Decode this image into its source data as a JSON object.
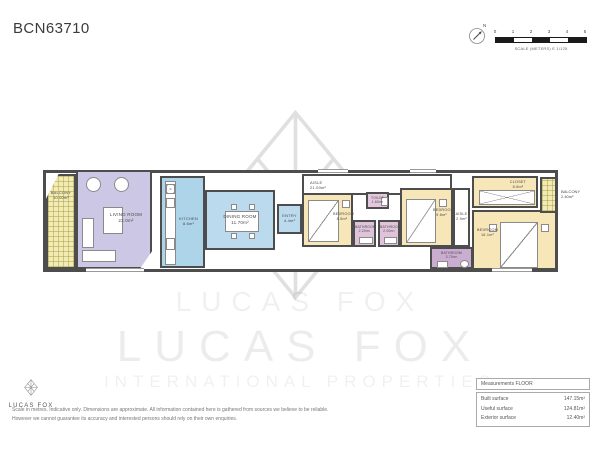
{
  "title": "BCN63710",
  "compass": {
    "north": "N"
  },
  "scale_bar": {
    "ticks": [
      "0",
      "1",
      "2",
      "3",
      "4",
      "5"
    ],
    "caption": "SCALE (METERS) E 1/125"
  },
  "watermark": {
    "small": "LUCAS FOX",
    "large": "LUCAS FOX",
    "sub": "INTERNATIONAL PROPERTIES"
  },
  "plan": {
    "rooms": {
      "balcony_left": {
        "name": "BALCONY",
        "area": "10.00m²"
      },
      "living_room": {
        "name": "LIVING ROOM",
        "area": "22.0m²"
      },
      "kitchen": {
        "name": "KITCHEN",
        "area": "8.6m²"
      },
      "dining_room": {
        "name": "DINING ROOM",
        "area": "11.70m²"
      },
      "entry": {
        "name": "ENTRY",
        "area": "4.4m²"
      },
      "aisle_main": {
        "name": "AISLE",
        "area": "21.00m²"
      },
      "bedroom_1": {
        "name": "BEDROOM",
        "area": "8.5m²"
      },
      "toilet": {
        "name": "TOILET",
        "area": "1.60m²"
      },
      "bathroom_1": {
        "name": "BATHROOM",
        "area": "2.20m²"
      },
      "bathroom_2": {
        "name": "BATHROOM",
        "area": "2.00m²"
      },
      "bedroom_2": {
        "name": "BEDROOM",
        "area": "9.6m²"
      },
      "aisle_2": {
        "name": "AISLE",
        "area": "2.9m²"
      },
      "bathroom_3": {
        "name": "BATHROOM",
        "area": "3.70m²"
      },
      "closet": {
        "name": "CLOSET",
        "area": "8.6m²"
      },
      "bedroom_3": {
        "name": "BEDROOM",
        "area": "16.1m²"
      },
      "balcony_right": {
        "name": "BALCONY",
        "area": "2.40m²"
      }
    }
  },
  "footer": {
    "brand": "LUCAS FOX",
    "disclaimer_line1": "Scale in metres. Indicative only. Dimensions are approximate. All information contained here is gathered from sources we believe to be reliable.",
    "disclaimer_line2": "However we cannot guarantee its accuracy and interested persons should rely on their own enquiries."
  },
  "measurements": {
    "header": "Measurements FLOOR",
    "rows": [
      {
        "label": "Built surface",
        "value": "147.15m²"
      },
      {
        "label": "Useful surface",
        "value": "124.81m²"
      },
      {
        "label": "Exterior surface",
        "value": "12.40m²"
      }
    ]
  },
  "colors": {
    "wall": "#4d4d4d",
    "bedroom": "#f7e6b8",
    "living": "#cdc7e6",
    "kitchen": "#aed4ea",
    "dining": "#bcdaed",
    "bathroom": "#dfc3da",
    "bathroom_dark": "#cbadd2",
    "balcony": "#f2ecb4"
  }
}
